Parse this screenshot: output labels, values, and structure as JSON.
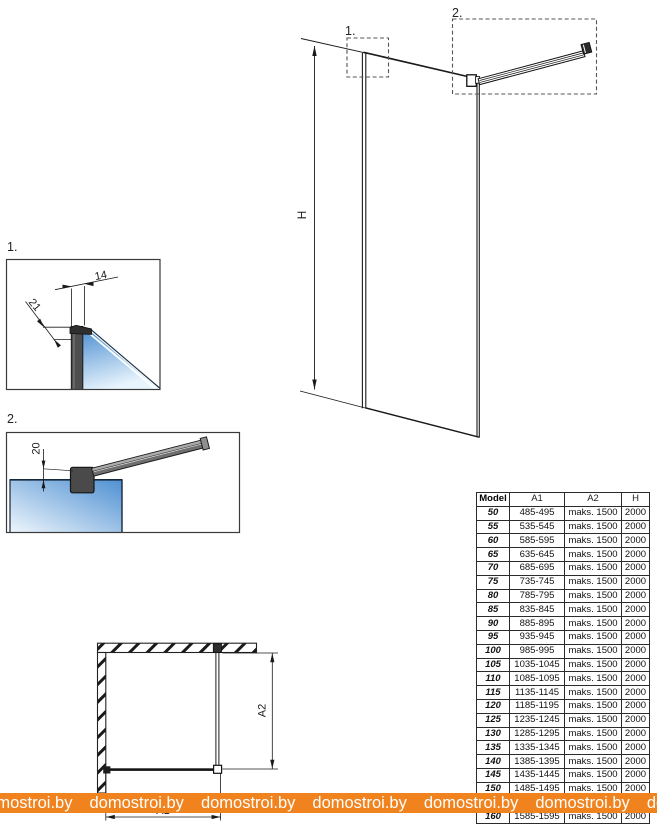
{
  "drawing": {
    "elevation": {
      "detail1_ref": "1.",
      "detail2_ref": "2.",
      "height_dim": "H"
    },
    "detail1": {
      "label": "1.",
      "width_dim": "14",
      "depth_dim": "21"
    },
    "detail2": {
      "label": "2.",
      "offset_dim": "20"
    },
    "plan": {
      "width_dim": "A1",
      "depth_dim": "A2"
    }
  },
  "colors": {
    "glass_blue_dark": "#5297d6",
    "glass_blue_light": "#eef6fc",
    "profile_gray": "#4e4e4e",
    "watermark_orange": "#f0831e",
    "watermark_text": "#ffffff",
    "line_black": "#1a1a1a"
  },
  "table": {
    "headers": [
      "Model",
      "A1",
      "A2",
      "H"
    ],
    "rows": [
      [
        "50",
        "485-495",
        "maks. 1500",
        "2000"
      ],
      [
        "55",
        "535-545",
        "maks. 1500",
        "2000"
      ],
      [
        "60",
        "585-595",
        "maks. 1500",
        "2000"
      ],
      [
        "65",
        "635-645",
        "maks. 1500",
        "2000"
      ],
      [
        "70",
        "685-695",
        "maks. 1500",
        "2000"
      ],
      [
        "75",
        "735-745",
        "maks. 1500",
        "2000"
      ],
      [
        "80",
        "785-795",
        "maks. 1500",
        "2000"
      ],
      [
        "85",
        "835-845",
        "maks. 1500",
        "2000"
      ],
      [
        "90",
        "885-895",
        "maks. 1500",
        "2000"
      ],
      [
        "95",
        "935-945",
        "maks. 1500",
        "2000"
      ],
      [
        "100",
        "985-995",
        "maks. 1500",
        "2000"
      ],
      [
        "105",
        "1035-1045",
        "maks. 1500",
        "2000"
      ],
      [
        "110",
        "1085-1095",
        "maks. 1500",
        "2000"
      ],
      [
        "115",
        "1135-1145",
        "maks. 1500",
        "2000"
      ],
      [
        "120",
        "1185-1195",
        "maks. 1500",
        "2000"
      ],
      [
        "125",
        "1235-1245",
        "maks. 1500",
        "2000"
      ],
      [
        "130",
        "1285-1295",
        "maks. 1500",
        "2000"
      ],
      [
        "135",
        "1335-1345",
        "maks. 1500",
        "2000"
      ],
      [
        "140",
        "1385-1395",
        "maks. 1500",
        "2000"
      ],
      [
        "145",
        "1435-1445",
        "maks. 1500",
        "2000"
      ],
      [
        "150",
        "1485-1495",
        "maks. 1500",
        "2000"
      ],
      [
        "155",
        "1535-1545",
        "maks. 1500",
        "2000"
      ],
      [
        "160",
        "1585-1595",
        "maks. 1500",
        "2000"
      ]
    ]
  },
  "watermark": {
    "text": "domostroi.by",
    "repeat": 7
  }
}
